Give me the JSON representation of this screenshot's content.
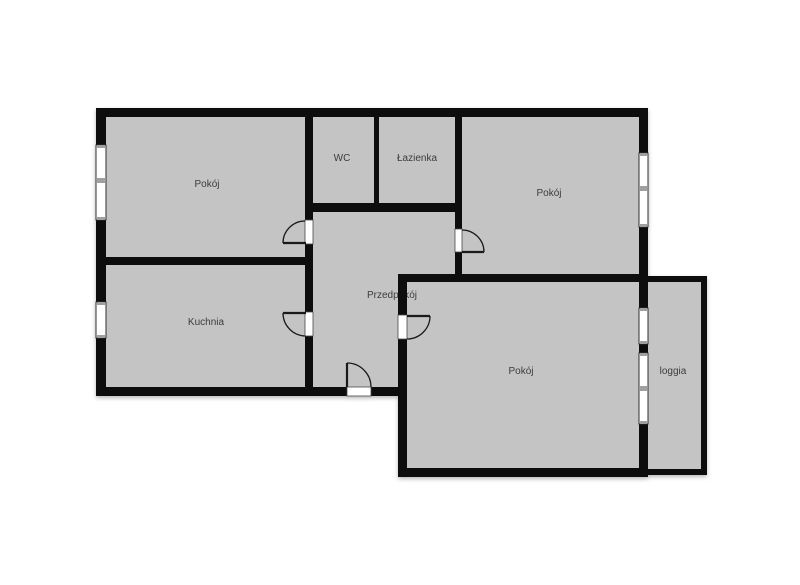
{
  "plan": {
    "type": "floor-plan",
    "canvas": {
      "width": 800,
      "height": 585
    },
    "colors": {
      "background": "#ffffff",
      "room_fill": "#c4c4c4",
      "wall": "#0d0d0d",
      "window_fill": "#ffffff",
      "window_frame": "#2f2f2f",
      "window_divider": "#a0a0a0",
      "door_gap_fill": "#ffffff",
      "door_gap_stroke": "#4a4a4a",
      "door_stroke": "#1a1a1a",
      "label_color": "#3c3c3c"
    },
    "rooms": [
      {
        "id": "pokoj-top-left",
        "label": "Pokój",
        "label_x": 207,
        "label_y": 187
      },
      {
        "id": "wc",
        "label": "WC",
        "label_x": 342,
        "label_y": 161
      },
      {
        "id": "lazienka",
        "label": "Łazienka",
        "label_x": 417,
        "label_y": 161
      },
      {
        "id": "pokoj-top-right",
        "label": "Pokój",
        "label_x": 549,
        "label_y": 196
      },
      {
        "id": "kuchnia",
        "label": "Kuchnia",
        "label_x": 206,
        "label_y": 325
      },
      {
        "id": "przedpokoj",
        "label": "Przedpokój",
        "label_x": 392,
        "label_y": 298
      },
      {
        "id": "pokoj-bottom-right",
        "label": "Pokój",
        "label_x": 521,
        "label_y": 374
      },
      {
        "id": "loggia",
        "label": "loggia",
        "label_x": 673,
        "label_y": 374
      }
    ],
    "floor_areas": [
      {
        "name": "floor-area-main-upper",
        "x": 100,
        "y": 112,
        "w": 544,
        "h": 280
      },
      {
        "name": "floor-area-lower-right",
        "x": 402,
        "y": 278,
        "w": 242,
        "h": 194
      },
      {
        "name": "floor-area-loggia",
        "x": 646,
        "y": 279,
        "w": 57,
        "h": 193
      }
    ],
    "walls": [
      {
        "name": "wall-outer-top",
        "x": 96,
        "y": 108,
        "w": 552,
        "h": 9
      },
      {
        "name": "wall-outer-left",
        "x": 96,
        "y": 108,
        "w": 10,
        "h": 288
      },
      {
        "name": "wall-outer-bottom-left",
        "x": 96,
        "y": 387,
        "w": 311,
        "h": 9
      },
      {
        "name": "wall-outer-right",
        "x": 639,
        "y": 108,
        "w": 9,
        "h": 369
      },
      {
        "name": "wall-pokoj-kuchnia",
        "x": 96,
        "y": 257,
        "w": 217,
        "h": 8
      },
      {
        "name": "wall-przedpokoj-left",
        "x": 305,
        "y": 108,
        "w": 8,
        "h": 288
      },
      {
        "name": "wall-wc-lazienka-bottom",
        "x": 305,
        "y": 203,
        "w": 157,
        "h": 9
      },
      {
        "name": "wall-wc-right",
        "x": 374,
        "y": 108,
        "w": 5,
        "h": 95
      },
      {
        "name": "wall-przedpokoj-right",
        "x": 455,
        "y": 108,
        "w": 7,
        "h": 174
      },
      {
        "name": "wall-mid-horizontal",
        "x": 398,
        "y": 274,
        "w": 250,
        "h": 8
      },
      {
        "name": "wall-pokoj-br-left",
        "x": 398,
        "y": 274,
        "w": 9,
        "h": 203
      },
      {
        "name": "wall-pokoj-br-bottom",
        "x": 398,
        "y": 468,
        "w": 250,
        "h": 9
      },
      {
        "name": "wall-loggia-top",
        "x": 648,
        "y": 276,
        "w": 59,
        "h": 6
      },
      {
        "name": "wall-loggia-right",
        "x": 701,
        "y": 276,
        "w": 6,
        "h": 199
      },
      {
        "name": "wall-loggia-bottom",
        "x": 648,
        "y": 469,
        "w": 59,
        "h": 6
      }
    ],
    "windows": [
      {
        "name": "window-pokoj-top-left",
        "x": 96,
        "y": 145,
        "w": 10,
        "h": 75,
        "dividers": [
          {
            "y": 145,
            "h": 3
          },
          {
            "y": 178,
            "h": 5
          },
          {
            "y": 217,
            "h": 3
          }
        ]
      },
      {
        "name": "window-kuchnia",
        "x": 96,
        "y": 302,
        "w": 10,
        "h": 36,
        "dividers": [
          {
            "y": 302,
            "h": 3
          },
          {
            "y": 335,
            "h": 3
          }
        ]
      },
      {
        "name": "window-pokoj-top-right",
        "x": 639,
        "y": 153,
        "w": 9,
        "h": 74,
        "dividers": [
          {
            "y": 153,
            "h": 3
          },
          {
            "y": 186,
            "h": 5
          },
          {
            "y": 224,
            "h": 3
          }
        ]
      },
      {
        "name": "window-pokoj-br-upper",
        "x": 639,
        "y": 308,
        "w": 9,
        "h": 36,
        "dividers": [
          {
            "y": 308,
            "h": 3
          },
          {
            "y": 341,
            "h": 3
          }
        ]
      },
      {
        "name": "window-balcony-door",
        "x": 639,
        "y": 353,
        "w": 9,
        "h": 71,
        "dividers": [
          {
            "y": 353,
            "h": 3
          },
          {
            "y": 386,
            "h": 5
          },
          {
            "y": 421,
            "h": 3
          }
        ]
      }
    ],
    "doors": [
      {
        "name": "door-pokoj-top-left",
        "gap": {
          "x": 305,
          "y": 220,
          "w": 8,
          "h": 24
        },
        "leaf": {
          "x1": 283,
          "y1": 243,
          "x2": 306,
          "y2": 243
        },
        "arc": "M305,221 A22,22 0 0 0 283,243"
      },
      {
        "name": "door-kuchnia",
        "gap": {
          "x": 305,
          "y": 312,
          "w": 8,
          "h": 24
        },
        "leaf": {
          "x1": 283,
          "y1": 313,
          "x2": 306,
          "y2": 313
        },
        "arc": "M283,313 A23,23 0 0 0 305,336"
      },
      {
        "name": "door-pokoj-top-right",
        "gap": {
          "x": 455,
          "y": 229,
          "w": 7,
          "h": 23
        },
        "leaf": {
          "x1": 462,
          "y1": 252,
          "x2": 484,
          "y2": 252
        },
        "arc": "M462,230 A22,22 0 0 1 484,252"
      },
      {
        "name": "door-pokoj-bottom-right",
        "gap": {
          "x": 398,
          "y": 315,
          "w": 9,
          "h": 24
        },
        "leaf": {
          "x1": 407,
          "y1": 316,
          "x2": 430,
          "y2": 316
        },
        "arc": "M430,316 A23,23 0 0 1 407,339"
      },
      {
        "name": "door-entrance",
        "gap": {
          "x": 347,
          "y": 387,
          "w": 24,
          "h": 9
        },
        "leaf": {
          "x1": 347,
          "y1": 387,
          "x2": 347,
          "y2": 363
        },
        "arc": "M347,363 A24,24 0 0 1 371,387"
      }
    ]
  }
}
